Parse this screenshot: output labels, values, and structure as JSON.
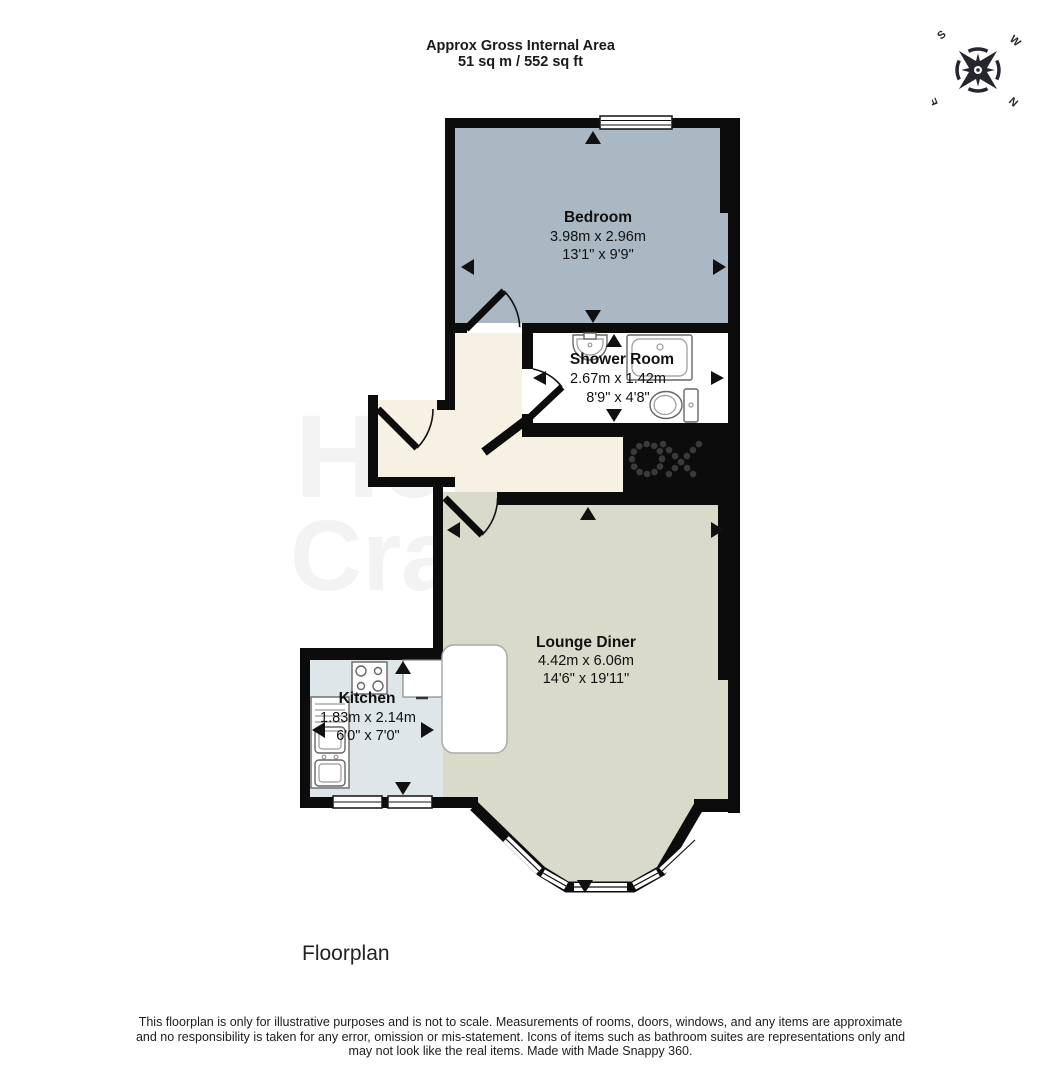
{
  "header": {
    "title_line1": "Approx Gross Internal Area",
    "title_line2": "51 sq m / 552 sq ft"
  },
  "compass": {
    "north": "N",
    "south": "S",
    "east": "E",
    "west": "W"
  },
  "rooms": {
    "bedroom": {
      "name": "Bedroom",
      "metric": "3.98m x 2.96m",
      "imperial": "13'1\" x 9'9\""
    },
    "shower_room": {
      "name": "Shower Room",
      "metric": "2.67m x 1.42m",
      "imperial": "8'9\" x 4'8\""
    },
    "lounge_diner": {
      "name": "Lounge Diner",
      "metric": "4.42m x 6.06m",
      "imperial": "14'6\" x 19'11\""
    },
    "kitchen": {
      "name": "Kitchen",
      "metric": "1.83m x 2.14m",
      "imperial": "6'0\" x 7'0\""
    }
  },
  "watermark": {
    "line1": "Hern",
    "line2": "Crabtree"
  },
  "caption": "Floorplan",
  "disclaimer": {
    "lines": [
      "This floorplan is only for illustrative purposes and is not to scale. Measurements of rooms, doors, windows, and any items are approximate",
      "and no responsibility is taken for any error, omission or mis-statement. Icons of items such as bathroom suites are representations only and",
      "may not look like the real items. Made with Made Snappy 360."
    ]
  },
  "colors": {
    "bedroom_fill": "#a9b8c2",
    "shower_fill": "#ffffff",
    "lounge_fill": "#d9dac9",
    "kitchen_fill": "#dfe6e9",
    "hallway_fill": "#f6f1e2",
    "wall": "#0c0c0c",
    "arrow": "#111111",
    "compass": "#26262e"
  }
}
